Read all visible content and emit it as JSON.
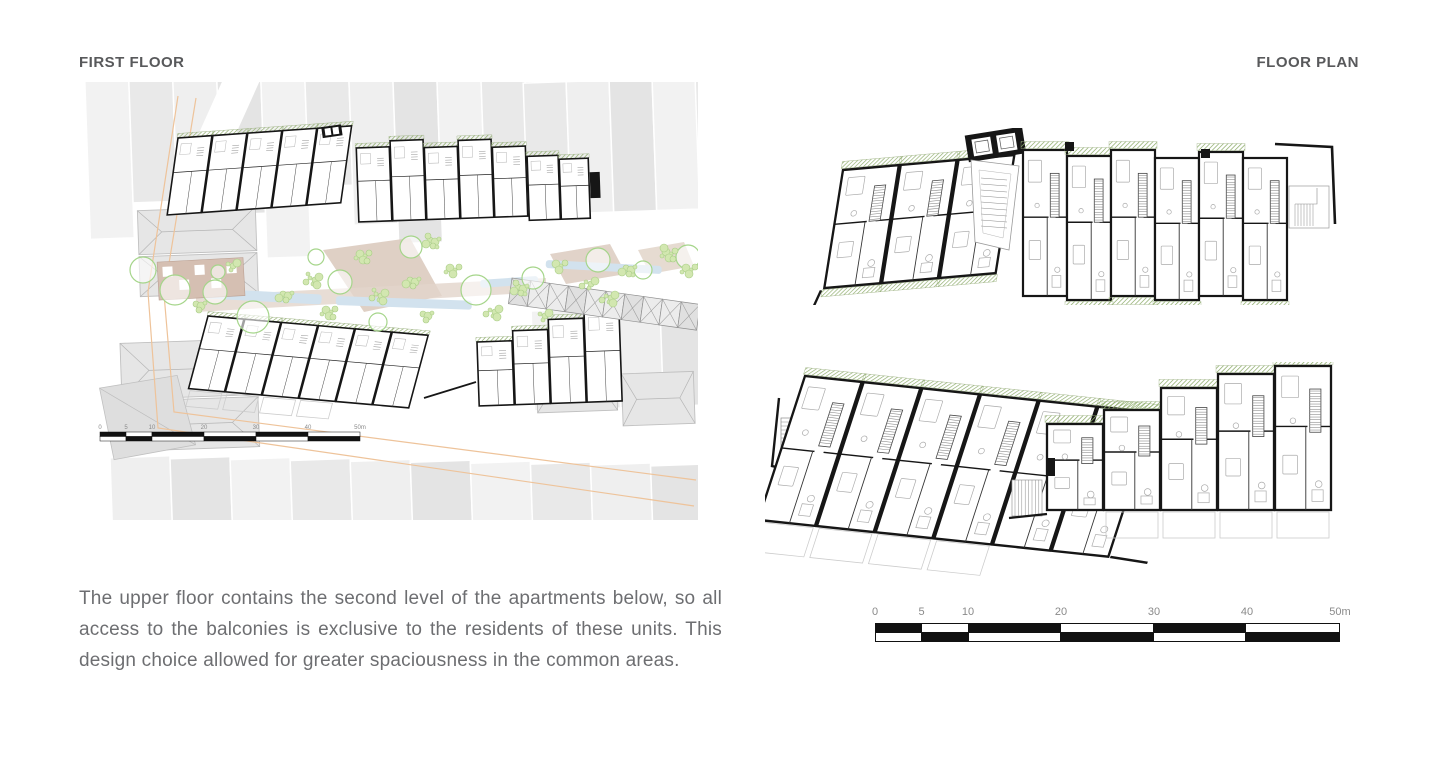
{
  "header": {
    "left_label": "FIRST FLOOR",
    "right_label": "FLOOR PLAN"
  },
  "description": {
    "paragraph": "The upper floor contains the second level of the apartments below, so all access to the balconies is exclusive to the residents of these units. This design choice allowed for greater spaciousness in the common areas."
  },
  "scale_bar": {
    "labels": [
      "0",
      "5",
      "10",
      "20",
      "30",
      "40",
      "50m"
    ],
    "label_positions_pct": [
      0,
      10,
      20,
      40,
      60,
      80,
      100
    ],
    "segment_widths_pct": [
      10,
      10,
      20,
      20,
      20,
      20
    ],
    "row1_fills": [
      "#111111",
      "#ffffff",
      "#111111",
      "#ffffff",
      "#111111",
      "#ffffff"
    ],
    "row2_fills": [
      "#ffffff",
      "#111111",
      "#ffffff",
      "#111111",
      "#ffffff",
      "#111111"
    ]
  },
  "site_scale_bar": {
    "labels": [
      "0",
      "5",
      "10",
      "20",
      "30",
      "40",
      "50m"
    ]
  },
  "colors": {
    "title_text": "#58595b",
    "body_text": "#6d6e71",
    "street_accent": "#eec39a",
    "tree_stroke": "#a5d58a",
    "shrub_fill": "#d2e7b0",
    "shrub_stroke": "#a9cd86",
    "water_fill": "#d2e2ee",
    "path_fill": "#d9c8bb",
    "context_fill": "#ededed",
    "context_stroke": "#d8d8d8",
    "wall_ink": "#161616",
    "balcony_hatch": "#8fae6d",
    "furniture": "#ababab",
    "ghost": "#cccccc",
    "scale_ink": "#111111",
    "scale_label": "#8a8a8a"
  }
}
